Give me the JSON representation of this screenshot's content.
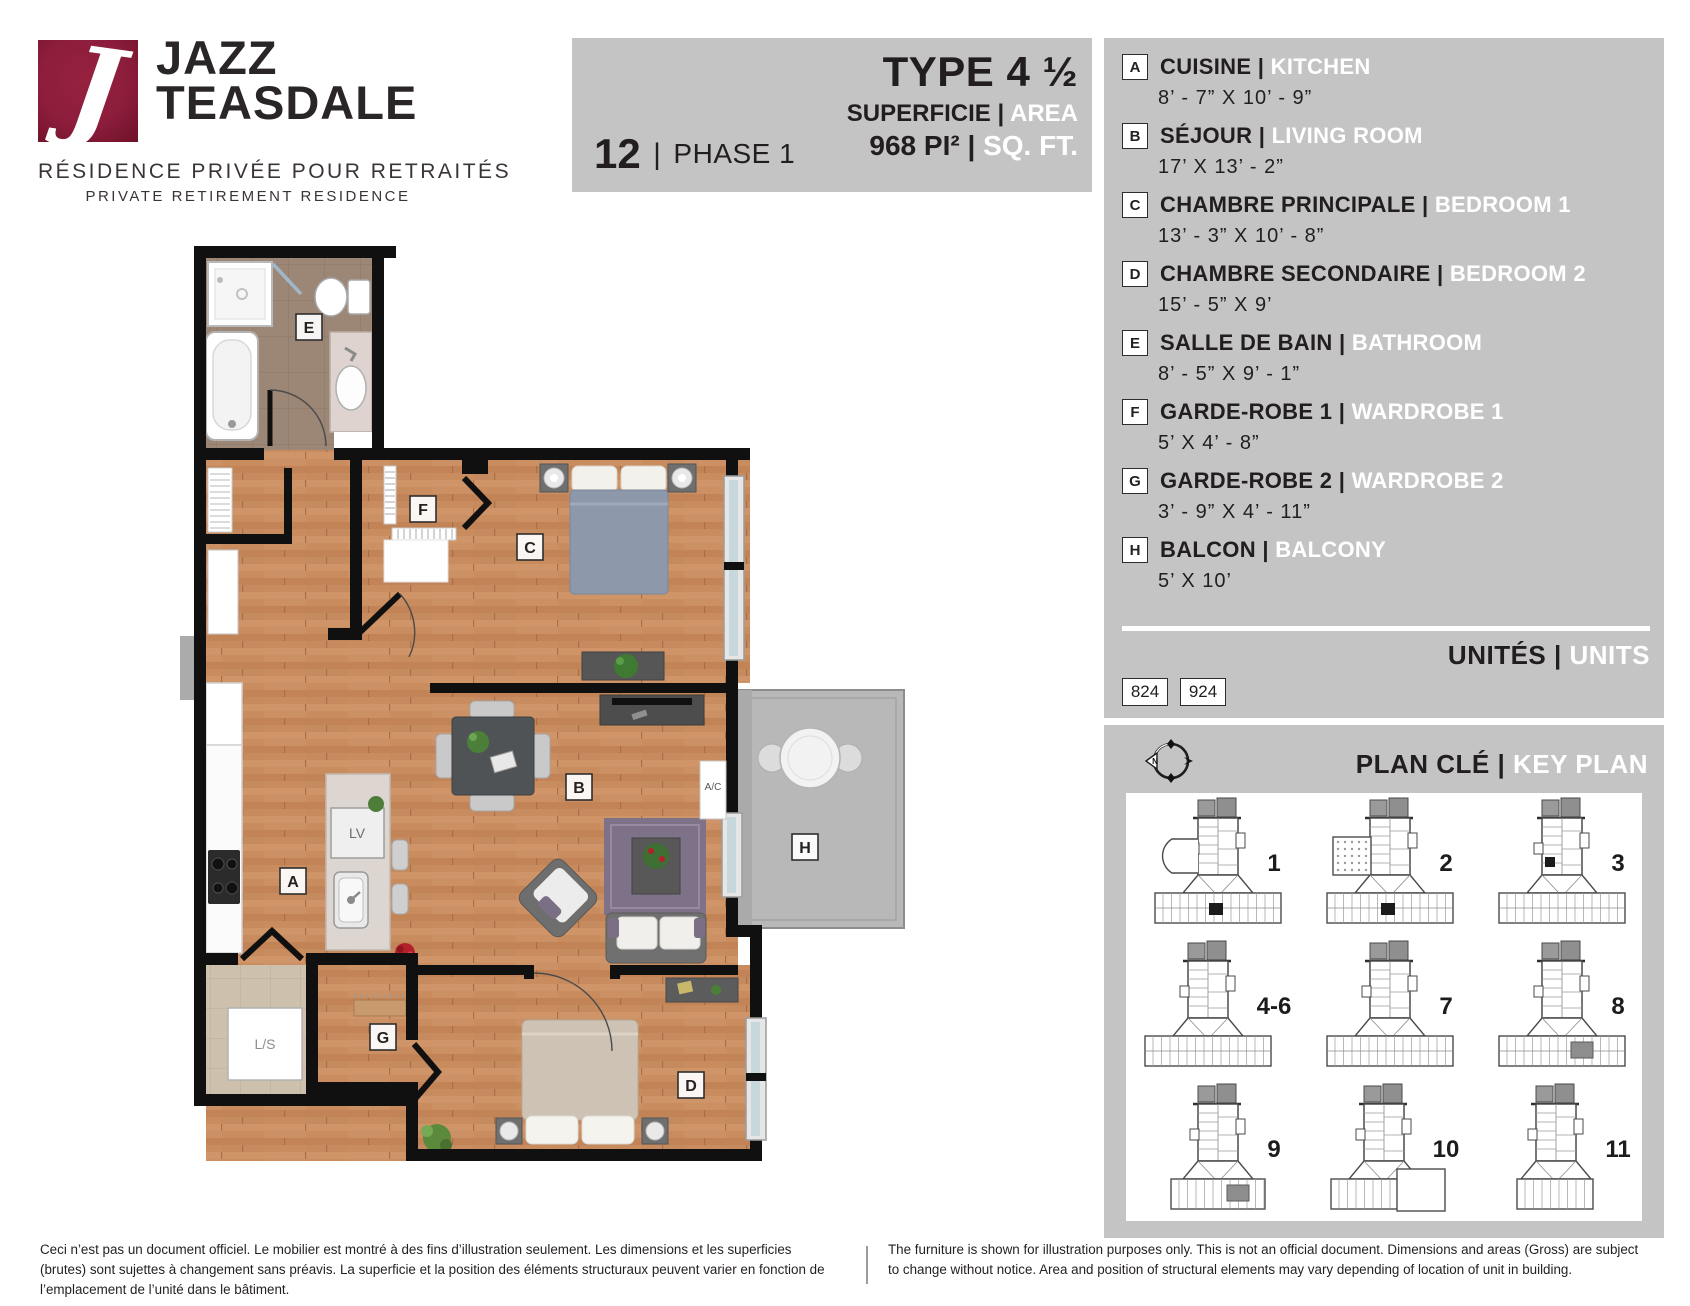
{
  "brand": {
    "logo_letter": "J",
    "logo_color": "#8c1d3b",
    "name_line1": "JAZZ",
    "name_line2": "TEASDALE",
    "tagline_fr": "RÉSIDENCE PRIVÉE POUR RETRAITÉS",
    "tagline_en": "PRIVATE RETIREMENT RESIDENCE"
  },
  "header": {
    "unit_number": "12",
    "separator": "|",
    "phase": "PHASE 1",
    "type_title": "TYPE 4 ½",
    "superficie_fr": "SUPERFICIE",
    "superficie_en": "AREA",
    "area_fr": "968 PI²",
    "area_en": "SQ. FT."
  },
  "legend": {
    "items": [
      {
        "letter": "A",
        "fr": "CUISINE",
        "en": "KITCHEN",
        "dims": "8’ - 7” X 10’ - 9”"
      },
      {
        "letter": "B",
        "fr": "SÉJOUR",
        "en": "LIVING ROOM",
        "dims": "17’ X 13’ - 2”"
      },
      {
        "letter": "C",
        "fr": "CHAMBRE PRINCIPALE",
        "en": "BEDROOM 1",
        "dims": "13’ - 3” X 10’ - 8”"
      },
      {
        "letter": "D",
        "fr": "CHAMBRE SECONDAIRE",
        "en": "BEDROOM 2",
        "dims": "15’ - 5” X 9’"
      },
      {
        "letter": "E",
        "fr": "SALLE DE BAIN",
        "en": "BATHROOM",
        "dims": "8’ - 5” X 9’ - 1”"
      },
      {
        "letter": "F",
        "fr": "GARDE-ROBE 1",
        "en": "WARDROBE 1",
        "dims": "5’ X 4’ - 8”"
      },
      {
        "letter": "G",
        "fr": "GARDE-ROBE 2",
        "en": "WARDROBE 2",
        "dims": "3’ - 9” X 4’ - 11”"
      },
      {
        "letter": "H",
        "fr": "BALCON",
        "en": "BALCONY",
        "dims": "5’ X 10’"
      }
    ],
    "units_fr": "UNITÉS",
    "units_en": "UNITS",
    "unit_badges": [
      "824",
      "924"
    ]
  },
  "keyplan": {
    "title_fr": "PLAN CLÉ",
    "title_en": "KEY PLAN",
    "compass_n": "N",
    "buildings": [
      {
        "label": "1",
        "variant": "wing",
        "marker": "black-base"
      },
      {
        "label": "2",
        "variant": "wing-dots",
        "marker": "black-base"
      },
      {
        "label": "3",
        "variant": "wide",
        "marker": "black-tower"
      },
      {
        "label": "4-6",
        "variant": "wide",
        "marker": "none"
      },
      {
        "label": "7",
        "variant": "wide",
        "marker": "none"
      },
      {
        "label": "8",
        "variant": "wide",
        "marker": "gray-base"
      },
      {
        "label": "9",
        "variant": "left",
        "marker": "gray-base"
      },
      {
        "label": "10",
        "variant": "annex",
        "marker": "none"
      },
      {
        "label": "11",
        "variant": "small",
        "marker": "none"
      }
    ]
  },
  "floorplan": {
    "rooms": {
      "a": "A",
      "b": "B",
      "c": "C",
      "d": "D",
      "e": "E",
      "f": "F",
      "g": "G",
      "h": "H"
    },
    "lv_label": "LV",
    "ls_label": "L/S",
    "ac_label": "A/C"
  },
  "disclaimer": {
    "fr": "Ceci n’est pas un document officiel. Le mobilier est montré à des fins d’illustration seulement. Les dimensions et les superficies (brutes) sont sujettes à changement sans préavis. La superficie et la position des éléments structuraux peuvent varier en fonction de l’emplacement de l’unité dans le bâtiment.",
    "en": "The furniture is shown for illustration purposes only. This is not an official document. Dimensions and areas (Gross) are subject to change without notice. Area and position of structural elements may vary depending of location of unit in building."
  }
}
